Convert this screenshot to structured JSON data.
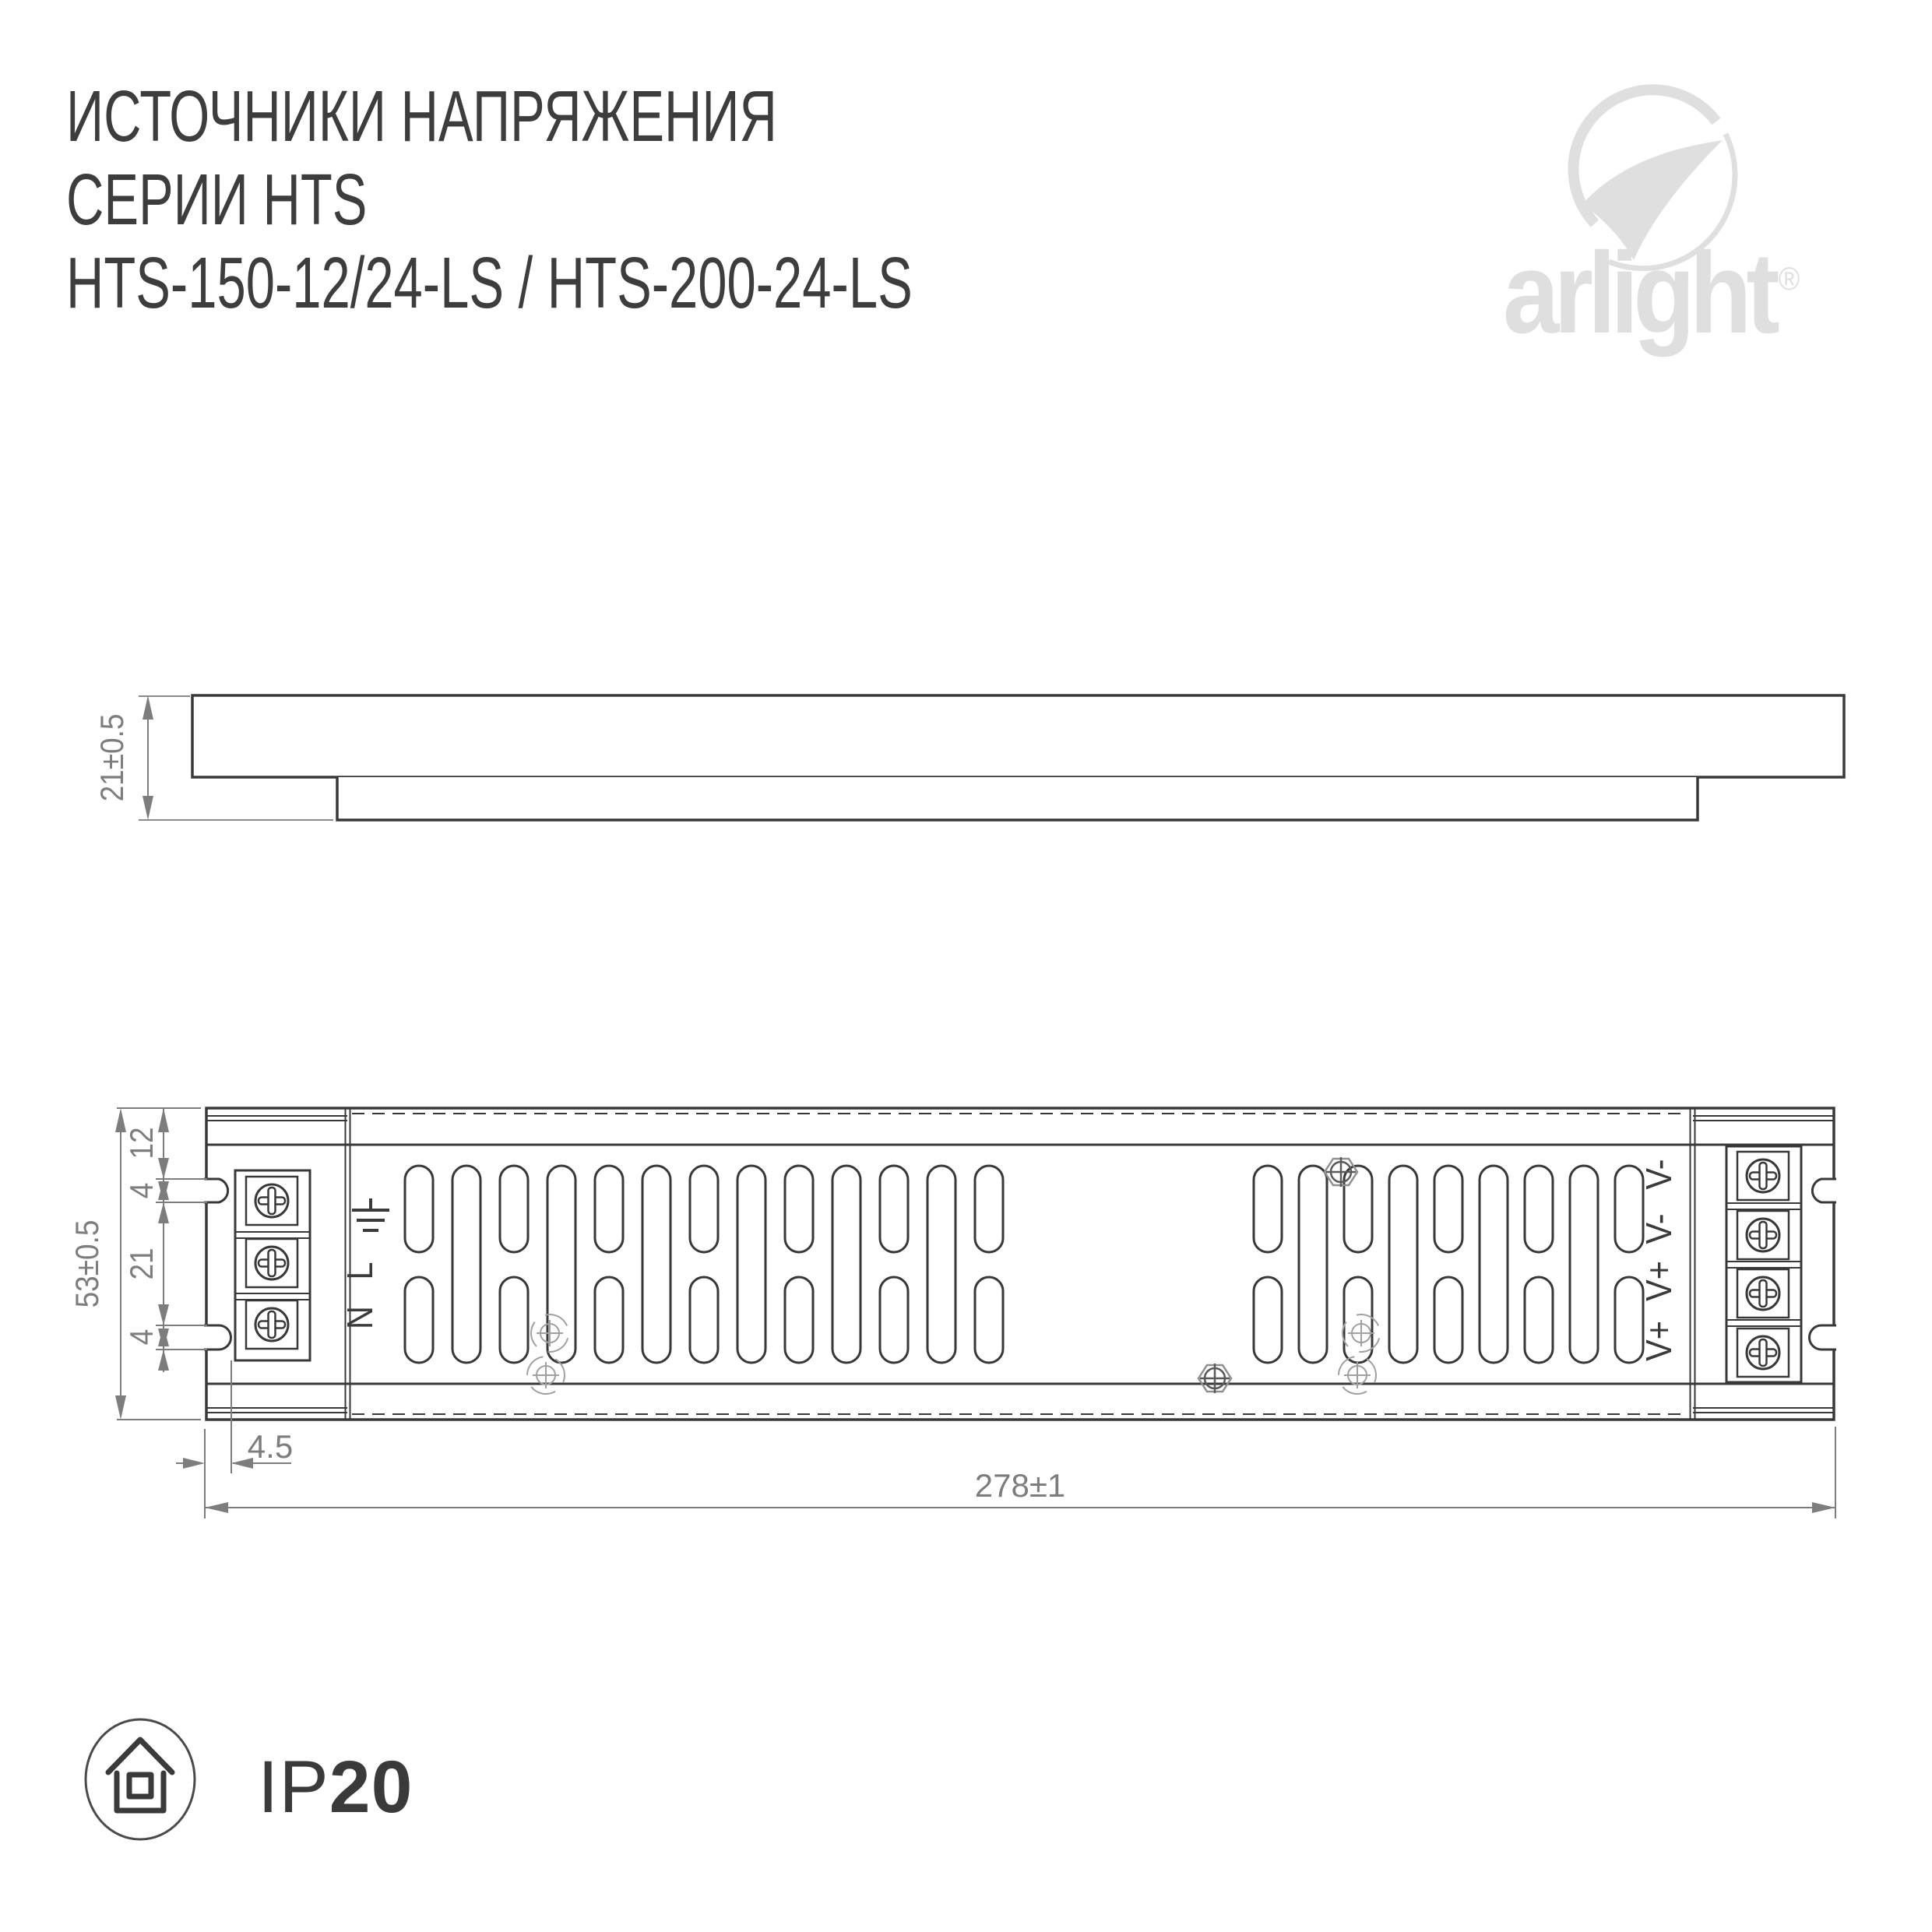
{
  "title": {
    "line1": "ИСТОЧНИКИ НАПРЯЖЕНИЯ",
    "line2": "СЕРИИ HTS",
    "line3": "HTS-150-12/24-LS / HTS-200-24-LS"
  },
  "logo": {
    "brand": "arlight",
    "registered": "®"
  },
  "side_view": {
    "height_dim": "21±0.5"
  },
  "top_view": {
    "overall_height_dim": "53±0.5",
    "chain_dims": [
      "12",
      "4",
      "21",
      "4"
    ],
    "notch_depth_dim": "4.5",
    "length_dim": "278±1",
    "input_terminal_labels": [
      "L",
      "N"
    ],
    "input_ground_icon": "earth-ground-icon",
    "output_terminal_labels": [
      "V-",
      "V-",
      "V+",
      "V+"
    ]
  },
  "ip_badge": {
    "prefix": "IP",
    "value": "20"
  },
  "colors": {
    "line_dark": "#383838",
    "dimension_gray": "#7d7d7d",
    "accent_light_gray": "#dfdfdf"
  }
}
